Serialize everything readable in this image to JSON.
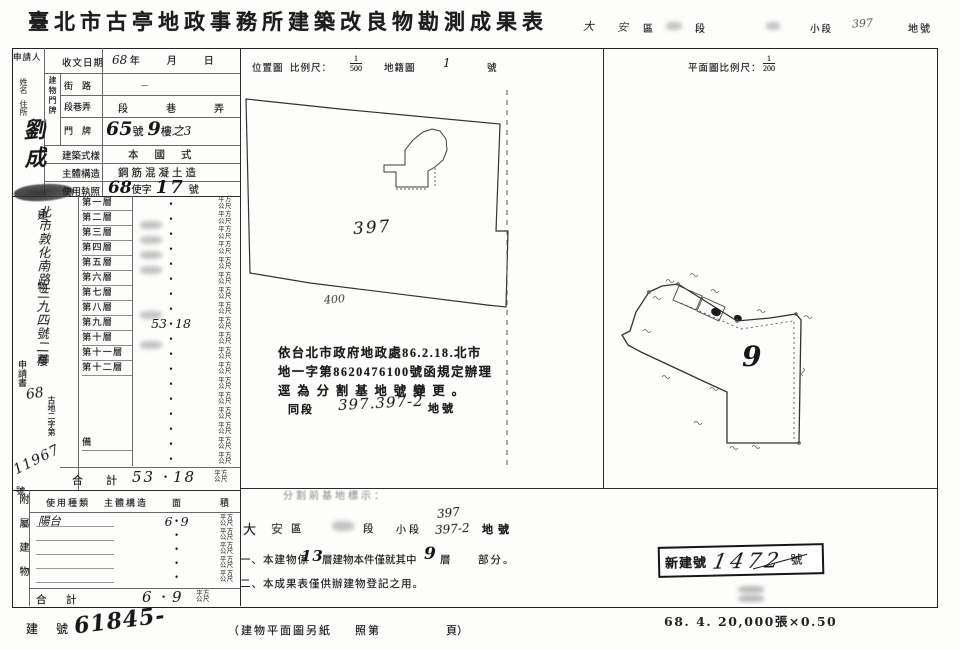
{
  "title": "臺北市古亭地政事務所建築改良物勘測成果表",
  "top_strip": {
    "hand_d1": "大",
    "hand_d2": "安",
    "district_label": "區",
    "section_label": "段",
    "subsection_label": "小段",
    "lot_hand": "397",
    "lot_label": "地號"
  },
  "left_panel": {
    "applicant_label": "申請人",
    "name_label": "姓名",
    "addr_label": "住所",
    "name_hand": "劉成",
    "address_hand": "北市敦化南路三九四號二樓",
    "doc_word": "申請書",
    "doc_year_hand": "68",
    "doc_series": "古地二字第",
    "doc_no_hand": "11967",
    "doc_suffix": "號"
  },
  "rows": {
    "door_vertical": "建物門牌",
    "received": {
      "label": "收文日期",
      "hand_year": "68",
      "y": "年",
      "m": "月",
      "d": "日"
    },
    "street": {
      "label": "街　路",
      "value": "－"
    },
    "lane": {
      "label": "段巷弄",
      "value": "段　巷　弄"
    },
    "plate": {
      "label": "門　牌",
      "h1": "65",
      "p1": "號",
      "h2": "9",
      "p2": "樓",
      "h3": "之3"
    },
    "style": {
      "label": "建築式樣",
      "value": "本國式"
    },
    "structure": {
      "label": "主體構造",
      "value": "鋼筋混凝土造"
    },
    "license": {
      "label": "使用執照",
      "h1": "68",
      "p1": "使字",
      "h2": "17",
      "p2": "號"
    }
  },
  "area_block": {
    "vertical_label": "建物面積",
    "dot": "•",
    "unit_line1": "平方",
    "unit_line2": "公尺",
    "floors": [
      {
        "label": "第一層",
        "value": ""
      },
      {
        "label": "第二層",
        "value": "",
        "smudge": true
      },
      {
        "label": "第三層",
        "value": "",
        "smudge": true
      },
      {
        "label": "第四層",
        "value": "",
        "smudge": true
      },
      {
        "label": "第五層",
        "value": "",
        "smudge": true
      },
      {
        "label": "第六層",
        "value": ""
      },
      {
        "label": "第七層",
        "value": ""
      },
      {
        "label": "第八層",
        "value": "",
        "smudge": true
      },
      {
        "label": "第九層",
        "value": "53.18"
      },
      {
        "label": "第十層",
        "value": "",
        "smudge": true
      },
      {
        "label": "第十一層",
        "value": ""
      },
      {
        "label": "第十二層",
        "value": ""
      },
      {
        "label": "",
        "value": ""
      },
      {
        "label": "",
        "value": ""
      },
      {
        "label": "",
        "value": ""
      },
      {
        "label": "",
        "value": ""
      },
      {
        "label": "備",
        "value": ""
      },
      {
        "label": "",
        "value": ""
      }
    ],
    "total_label_1": "合",
    "total_label_2": "計",
    "total_value": "53.18"
  },
  "annex_block": {
    "vertical_label": "附屬建物",
    "header_kind": "使用種類",
    "header_structure": "主體構造",
    "header_area_1": "面",
    "header_area_2": "積",
    "rows": [
      {
        "kind": "陽台",
        "value": "6.9"
      },
      {
        "kind": "",
        "value": ""
      },
      {
        "kind": "",
        "value": ""
      },
      {
        "kind": "",
        "value": ""
      },
      {
        "kind": "",
        "value": ""
      }
    ],
    "total_label_1": "合",
    "total_label_2": "計",
    "total_value": "6.9",
    "unit_line1": "平方",
    "unit_line2": "公尺"
  },
  "bottom_line": {
    "label_1": "建",
    "label_2": "號",
    "hand": "61845-",
    "plan_note_1": "（建物平面圖另紙",
    "plan_note_2": "照第",
    "plan_note_3": "頁）"
  },
  "map_header": {
    "t1": "位置圖",
    "t2": "比例尺：",
    "num": "1",
    "den": "500",
    "t3": "地籍圖",
    "hand": "1",
    "t4": "號"
  },
  "plan_header": {
    "t1": "平面圖比例尺：",
    "num": "1",
    "den": "200"
  },
  "map": {
    "lot_hand": "397",
    "adj_hand": "400"
  },
  "plan": {
    "floor_hand": "9"
  },
  "reg_note": {
    "line1": "依台北市政府地政處86.2.18.北市",
    "line2": "地一字第8620476100號函規定辦理",
    "line3": "逕為分割基地號變更。",
    "line4_p1": "同段",
    "line4_hand": "397.397-2",
    "line4_p2": "地號"
  },
  "notes": {
    "faint": "分割前基地標示：",
    "addr": {
      "p1": "大",
      "p2": "安",
      "p3": "區",
      "p4": "段",
      "p5": "小段",
      "hand_a": "397",
      "hand_b": "397-2",
      "p6": "地號"
    },
    "n1": {
      "p1": "一、本建物係",
      "h1": "13",
      "p2": "層建物本件僅就其中",
      "h2": "9",
      "p3": "層",
      "p4": "部分。"
    },
    "n2": "二、本成果表僅供辦建物登記之用。"
  },
  "stamp": {
    "prefix": "新建號",
    "hand": "1472",
    "suffix": "號"
  },
  "print_code": "68. 4. 20,000張×0.50"
}
